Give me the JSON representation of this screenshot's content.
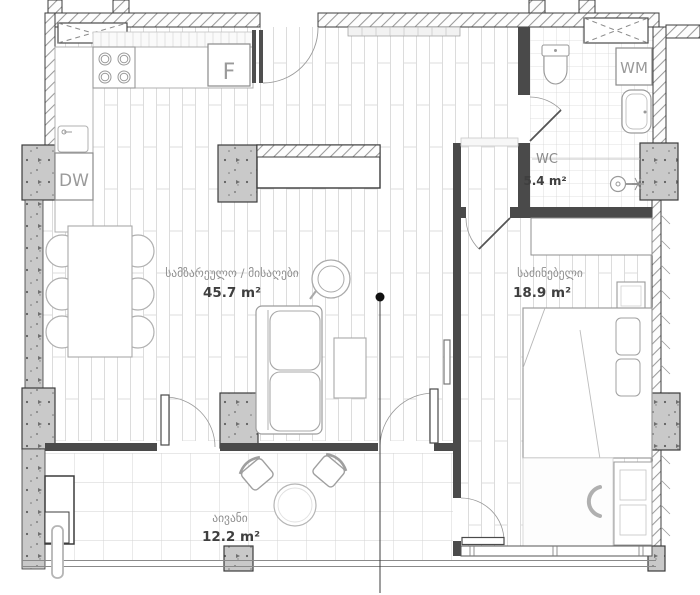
{
  "plan": {
    "rooms": {
      "living": {
        "name": "სამზარეულო / მისაღები",
        "area": "45.7 m²"
      },
      "bedroom": {
        "name": "საძინებელი",
        "area": "18.9 m²"
      },
      "wc": {
        "name": "WC",
        "area": "5.4 m²"
      },
      "balcony": {
        "name": "აივანი",
        "area": "12.2 m²"
      }
    },
    "appliances": {
      "fridge": "F",
      "dishwasher": "DW",
      "washing_machine": "WM"
    },
    "icons": {
      "section_marker": "section-line-marker"
    },
    "colors": {
      "background": "#ffffff",
      "wall_outline": "#3c3c3c",
      "partition_wall": "#4a4a4a",
      "hatch_line": "#9a9a9a",
      "concrete_fill": "#c9c9c9",
      "plank_line": "#dcdcdc",
      "tile_line": "#d4d4d4",
      "furniture_line": "#a0a0a0",
      "room_label": "#8f8f8f",
      "area_label": "#3f3f3f",
      "section_marker": "#111111"
    }
  }
}
